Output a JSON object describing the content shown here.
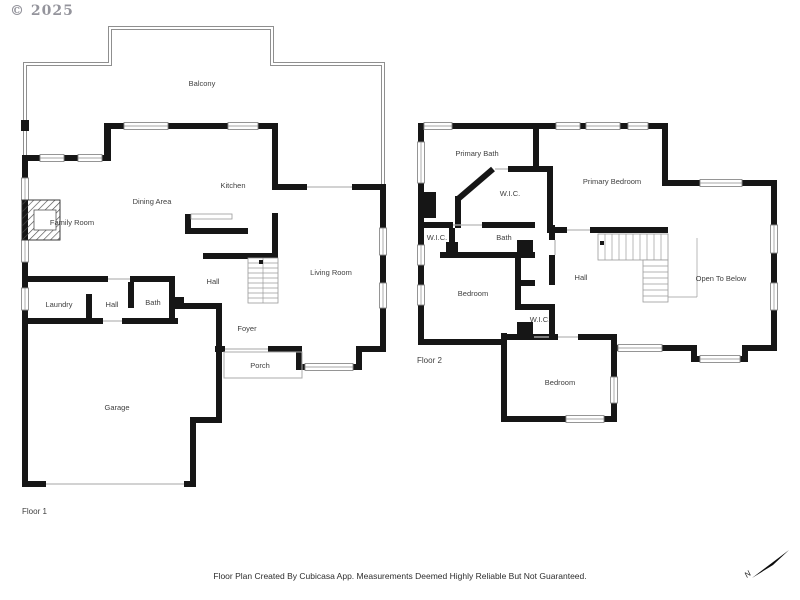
{
  "copyright": "© 2025",
  "footer": {
    "disclaimer": "Floor Plan Created By Cubicasa App. Measurements Deemed Highly Reliable But Not Guaranteed."
  },
  "compass": {
    "label": "N"
  },
  "colors": {
    "wall": "#161616",
    "thin_line": "#b8b8b8",
    "railing": "#8f8f8f",
    "label_text": "#3f3f3f",
    "copyright_text": "#94949c"
  },
  "floor1": {
    "name": "Floor 1",
    "rooms": {
      "balcony": "Balcony",
      "kitchen": "Kitchen",
      "dining": "Dining Area",
      "family": "Family Room",
      "laundry": "Laundry",
      "hall_a": "Hall",
      "bath": "Bath",
      "hall_b": "Hall",
      "living": "Living Room",
      "foyer": "Foyer",
      "porch": "Porch",
      "garage": "Garage"
    }
  },
  "floor2": {
    "name": "Floor 2",
    "rooms": {
      "primary_bath": "Primary Bath",
      "wic_primary": "W.I.C.",
      "primary_bedroom": "Primary Bedroom",
      "wic_a": "W.I.C.",
      "bath": "Bath",
      "bedroom_w": "Bedroom",
      "hall": "Hall",
      "wic_b": "W.I.C.",
      "open_below": "Open To Below",
      "bedroom_s": "Bedroom"
    }
  }
}
